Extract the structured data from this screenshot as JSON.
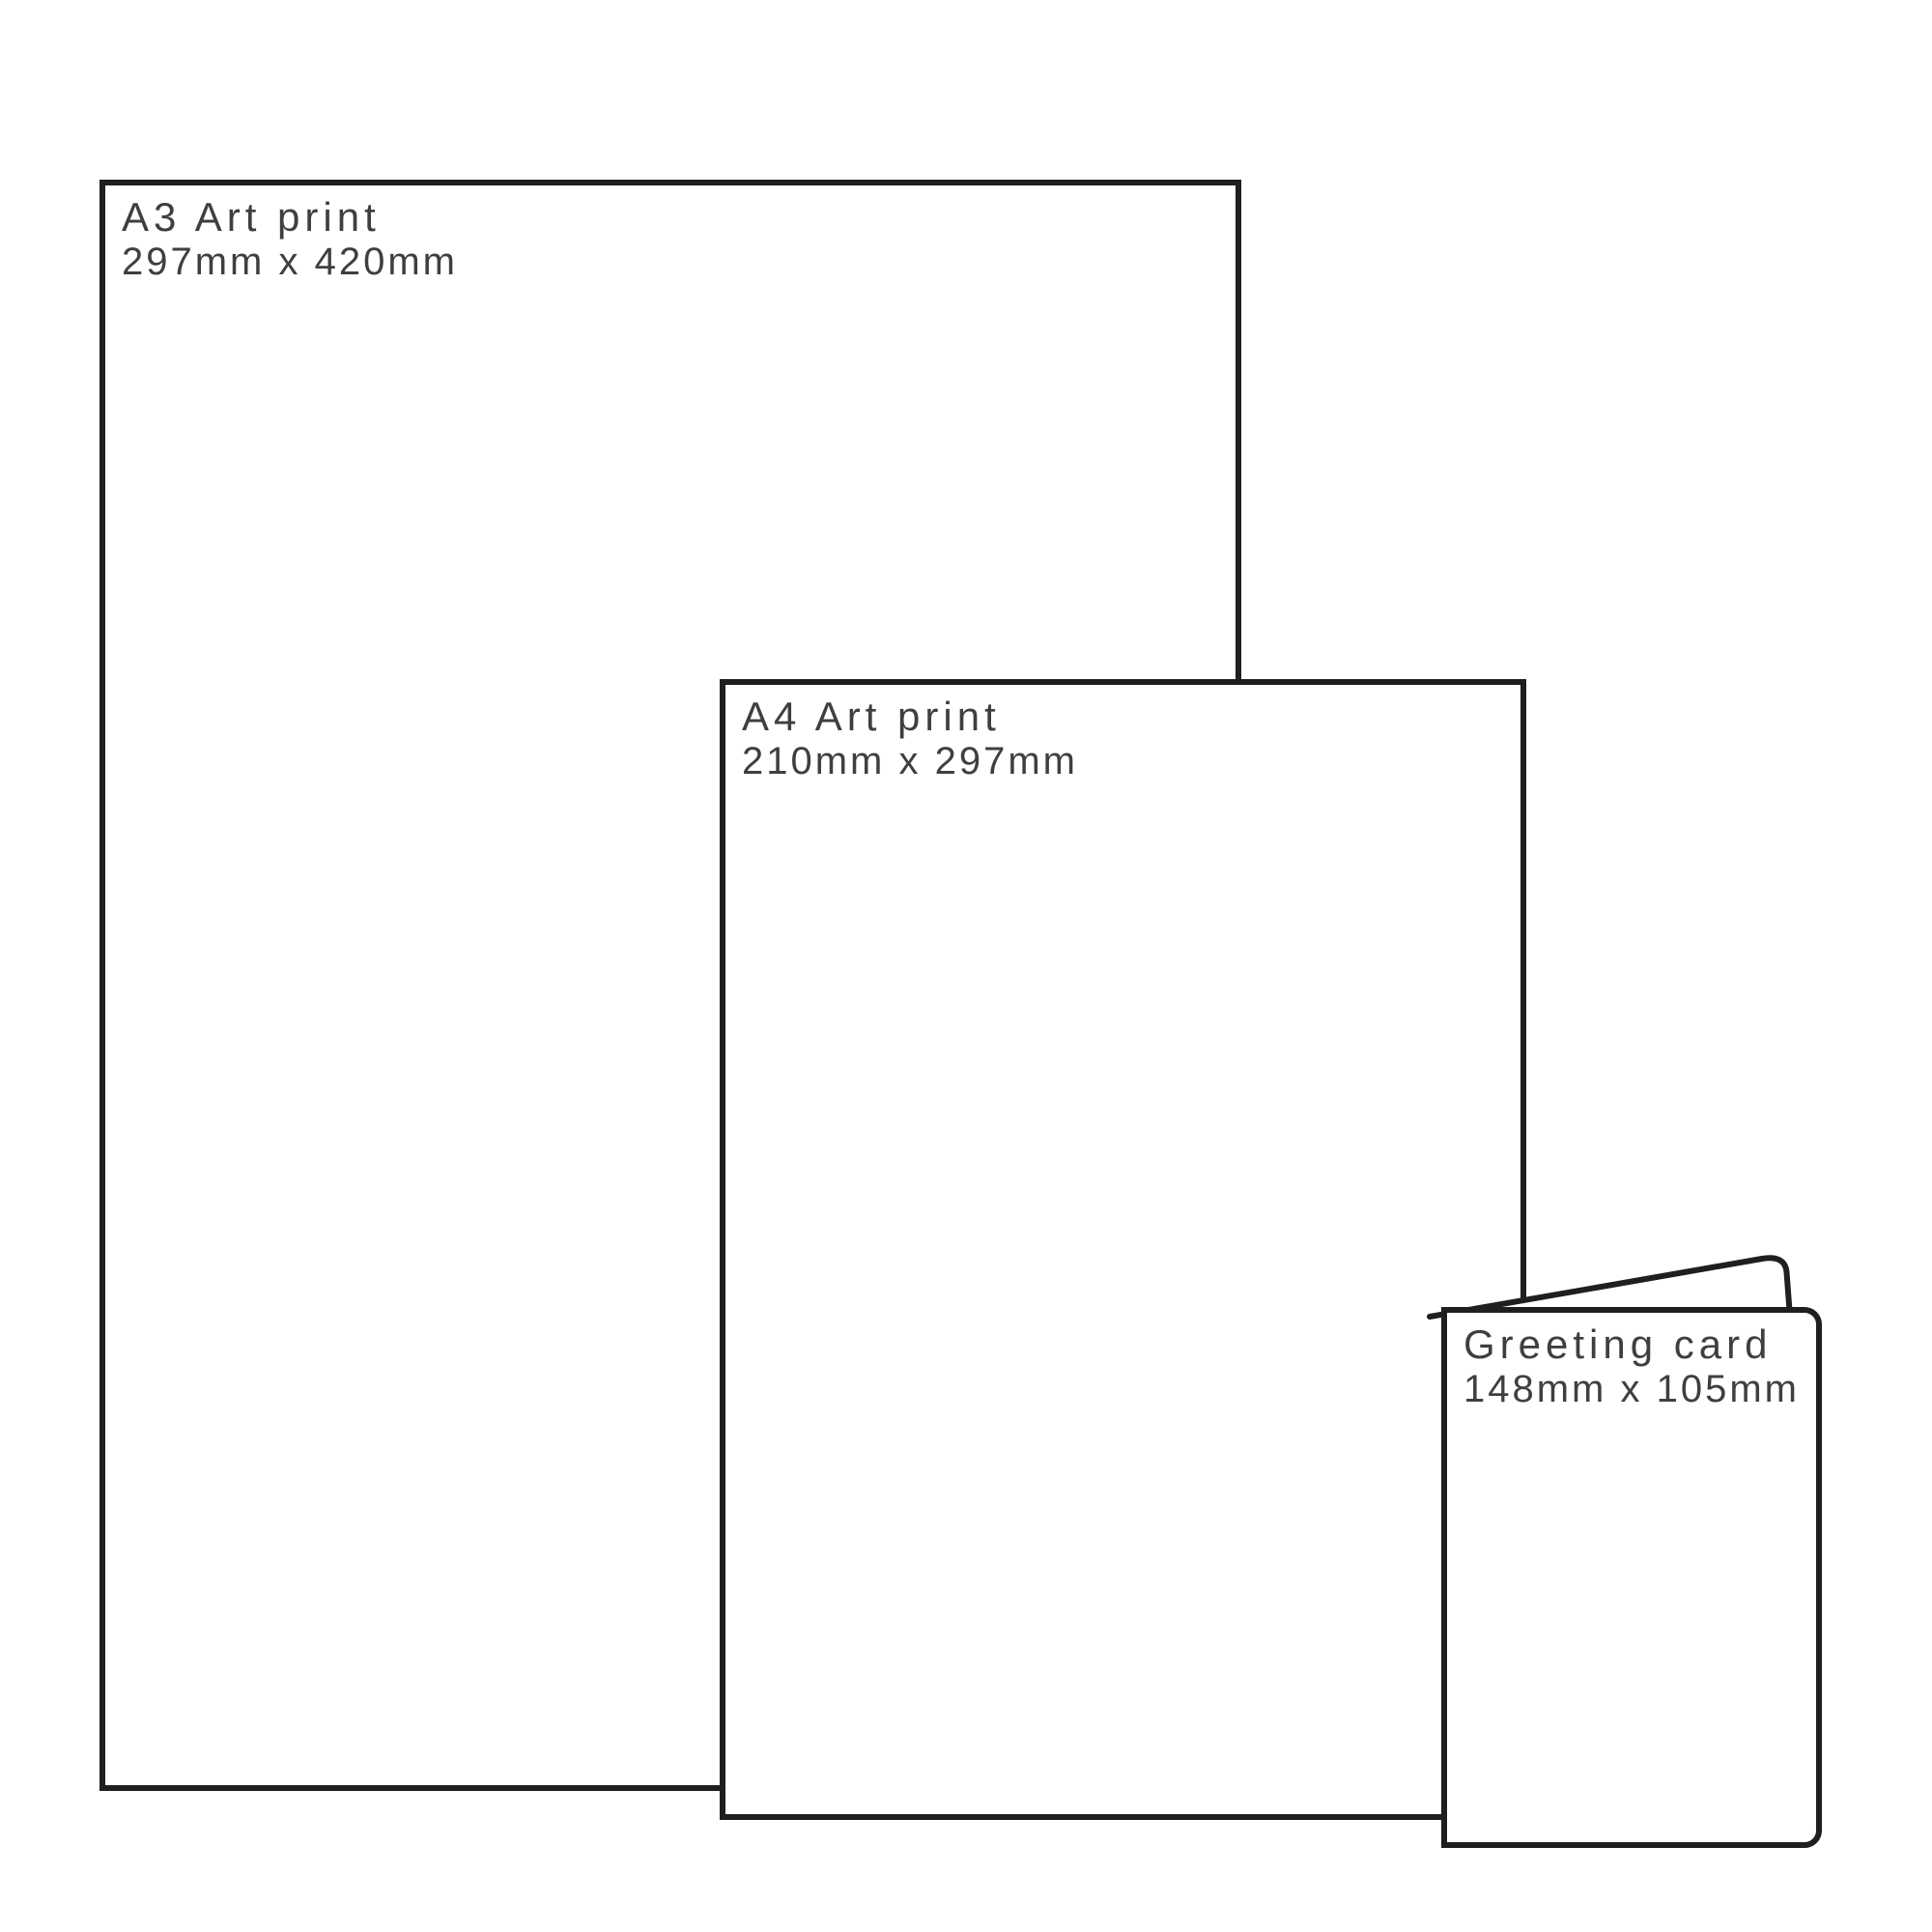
{
  "diagram_type": "print-size-comparison",
  "colors": {
    "outline": "#1f1f1f",
    "label_text": "#3f3f3f",
    "background": "#ffffff"
  },
  "prints": [
    {
      "id": "a3",
      "title": "A3 Art print",
      "dimensions": "297mm x 420mm"
    },
    {
      "id": "a4",
      "title": "A4 Art print",
      "dimensions": "210mm x 297mm"
    },
    {
      "id": "card",
      "title": "Greeting card",
      "dimensions": "148mm x 105mm"
    }
  ]
}
